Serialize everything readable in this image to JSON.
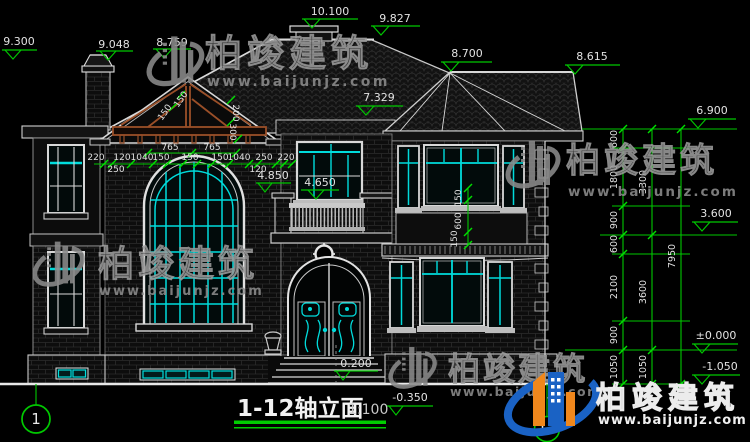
{
  "title": {
    "name": "1-12轴立面",
    "scale": "1:100"
  },
  "axis": {
    "left": "1",
    "right": "12"
  },
  "brand": {
    "name": "柏竣建筑",
    "url": "www.baijunjz.com"
  },
  "levels": {
    "left_chimney_top": "9.300",
    "main_slope_left": "9.048",
    "gable_ridge": "8.759",
    "chimney_top": "10.100",
    "main_ridge": "9.827",
    "hip_apex": "8.700",
    "hip_ridge_end": "8.615",
    "right_eave": "7.329",
    "right_eave_level": "6.900",
    "second_floor": "3.600",
    "ground_floor": "±0.000",
    "site_level": "-1.050",
    "balcony_pier": "4.850",
    "balcony_rail": "4.650",
    "entry_step": "0.200",
    "grade": "-0.350"
  },
  "hchain": {
    "a": "220",
    "b": "120",
    "c": "1040",
    "d": "150",
    "e": "150",
    "f": "150",
    "g": "1040",
    "h": "250",
    "i": "220",
    "sub_left": "250",
    "sub_right": "120",
    "arch_left": "765",
    "arch_right": "765"
  },
  "truss_dims": {
    "a": "150",
    "b": "150",
    "c": "200",
    "d": "300"
  },
  "window_dims": {
    "a": "150",
    "b": "600",
    "c": "150"
  },
  "vchain": {
    "s1": "600",
    "s2": "1800",
    "s3": "900",
    "s4": "600",
    "s5": "2100",
    "s6": "900",
    "s7": "1050",
    "t1": "3300",
    "t2": "3600",
    "t3": "1050",
    "total": "7950"
  },
  "colors": {
    "background": "#000000",
    "line_white": "#d9d9d9",
    "dim_green": "#00c800",
    "glass_cyan": "#00dcdc",
    "truss_brown": "#9a4f28",
    "watermark_gray": "#8c8c8c",
    "brand_blue": "#1a62c4",
    "brand_orange": "#f0871c"
  }
}
